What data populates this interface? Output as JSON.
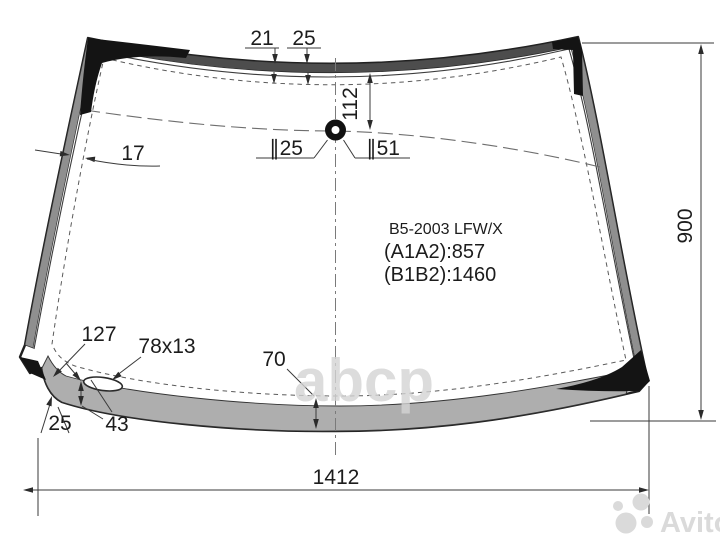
{
  "title_block": {
    "part_code": "B5-2003 LFW/X",
    "a1a2": "(A1A2):857",
    "b1b2": "(B1B2):1460"
  },
  "dimensions": {
    "top_band_left": "21",
    "top_band_right": "25",
    "sensor_offset": "112",
    "sensor_hole_small": "∥25",
    "sensor_hole_large": "∥51",
    "left_edge_width": "17",
    "glass_height": "900",
    "slot_offset": "127",
    "slot_size": "78x13",
    "bottom_band_center_width": "70",
    "corner_band_width": "25",
    "left_band_width": "43",
    "glass_width": "1412"
  },
  "watermarks": {
    "center": "abcp",
    "corner": "Avito"
  },
  "colors": {
    "outline": "#1f1f1f",
    "top_band": "#4d4d4d",
    "side_band": "#8f8f8f",
    "bottom_band": "#aeaeae",
    "corner_patch": "#141414",
    "watermark": "#d9d9d9"
  }
}
